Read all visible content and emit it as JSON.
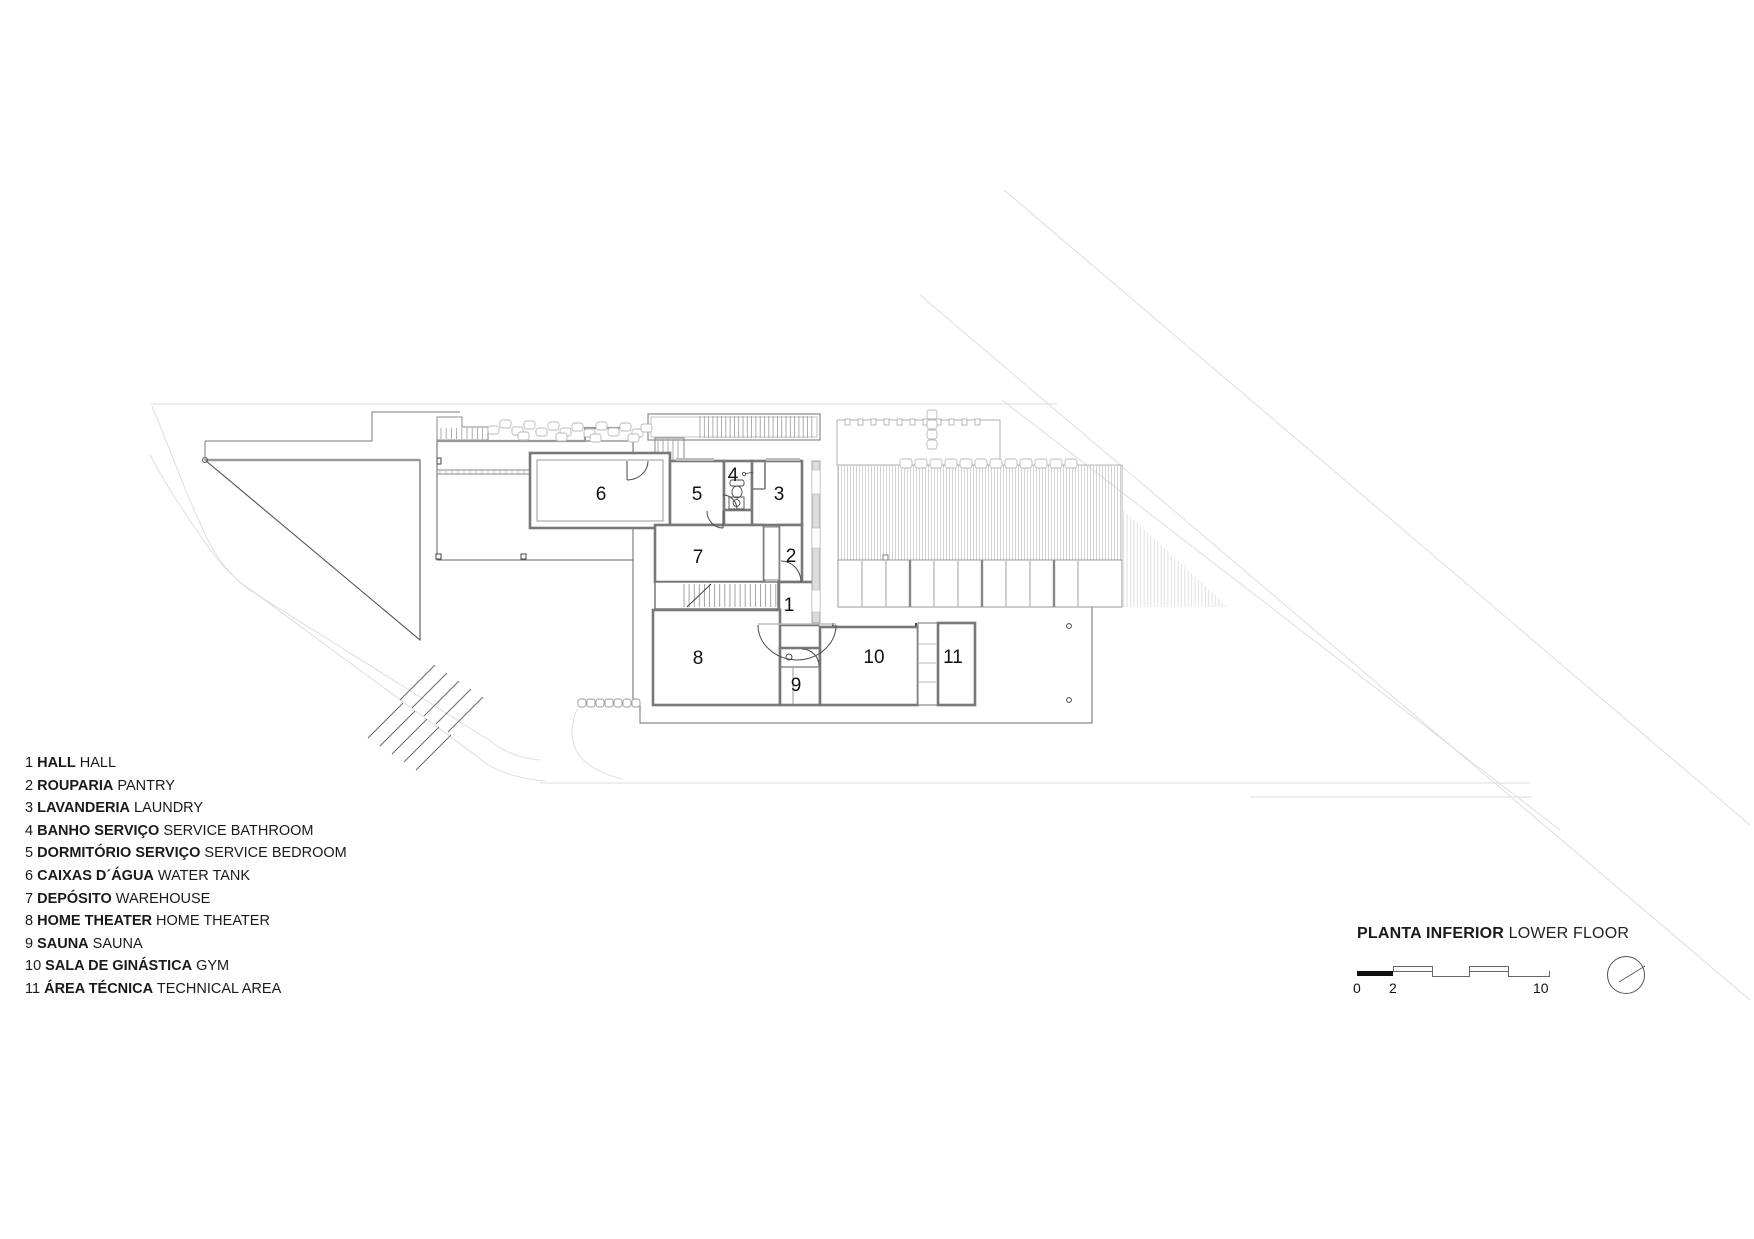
{
  "title": {
    "pt": "PLANTA INFERIOR",
    "en": "LOWER FLOOR"
  },
  "legend": {
    "items": [
      {
        "num": "1",
        "pt": "HALL",
        "en": "HALL"
      },
      {
        "num": "2",
        "pt": "ROUPARIA",
        "en": "PANTRY"
      },
      {
        "num": "3",
        "pt": "LAVANDERIA",
        "en": "LAUNDRY"
      },
      {
        "num": "4",
        "pt": "BANHO SERVIÇO",
        "en": "SERVICE BATHROOM"
      },
      {
        "num": "5",
        "pt": "DORMITÓRIO SERVIÇO",
        "en": "SERVICE BEDROOM"
      },
      {
        "num": "6",
        "pt": "CAIXAS D´ÁGUA",
        "en": "WATER TANK"
      },
      {
        "num": "7",
        "pt": "DEPÓSITO",
        "en": "WAREHOUSE"
      },
      {
        "num": "8",
        "pt": "HOME THEATER",
        "en": "HOME THEATER"
      },
      {
        "num": "9",
        "pt": "SAUNA",
        "en": "SAUNA"
      },
      {
        "num": "10",
        "pt": "SALA DE GINÁSTICA",
        "en": "GYM"
      },
      {
        "num": "11",
        "pt": "ÁREA TÉCNICA",
        "en": "TECHNICAL AREA"
      }
    ]
  },
  "plan": {
    "rooms": [
      {
        "num": "1",
        "x": 789,
        "y": 611
      },
      {
        "num": "2",
        "x": 791,
        "y": 562
      },
      {
        "num": "3",
        "x": 779,
        "y": 500
      },
      {
        "num": "4",
        "x": 733,
        "y": 481
      },
      {
        "num": "5",
        "x": 697,
        "y": 500
      },
      {
        "num": "6",
        "x": 601,
        "y": 500
      },
      {
        "num": "7",
        "x": 698,
        "y": 563
      },
      {
        "num": "8",
        "x": 698,
        "y": 664
      },
      {
        "num": "9",
        "x": 796,
        "y": 691
      },
      {
        "num": "10",
        "x": 874,
        "y": 663
      },
      {
        "num": "11",
        "x": 953,
        "y": 663
      }
    ]
  },
  "scalebar": {
    "zero": "0",
    "two": "2",
    "ten": "10"
  },
  "colors": {
    "wall": "#787878",
    "wall_light": "#b8b8b8",
    "fixture": "#4a4a4a",
    "site": "#555555",
    "faint": "#dedede",
    "hatch": "#cccccc",
    "ink": "#111111"
  }
}
